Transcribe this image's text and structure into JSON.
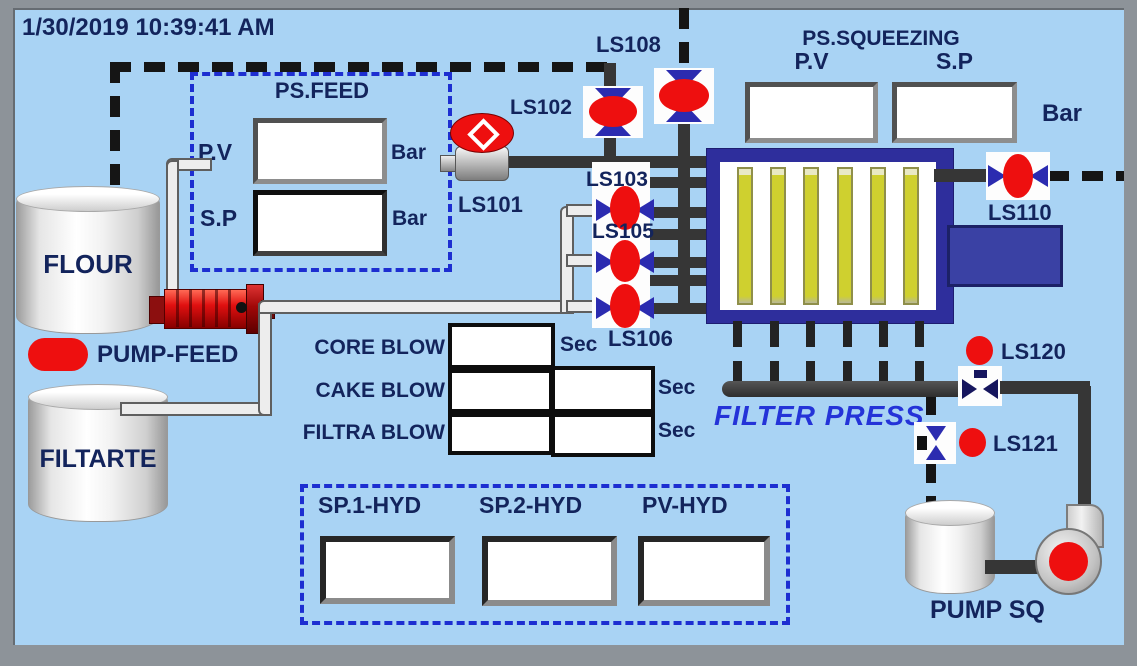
{
  "colors": {
    "background": "#a9d3f4",
    "frame_gray": "#8d9399",
    "text_navy": "#13245c",
    "dashed_blue": "#1d2ed1",
    "pipe_dark": "#363636",
    "alarm_red": "#ee0f0f",
    "valve_blue": "#2b2bb0",
    "press_frame_blue": "#2e2e9c",
    "plate_yellow": "#cfd02f",
    "press_head_blue": "#3a41a4",
    "filter_press_text": "#2433d8"
  },
  "header": {
    "timestamp": "1/30/2019 10:39:41 AM"
  },
  "ps_feed": {
    "title": "PS.FEED",
    "pv_label": "P.V",
    "pv_value": "",
    "pv_unit": "Bar",
    "sp_label": "S.P",
    "sp_value": "",
    "sp_unit": "Bar"
  },
  "ps_squeezing": {
    "title": "PS.SQUEEZING",
    "pv_label": "P.V",
    "pv_value": "",
    "sp_label": "S.P",
    "sp_value": "",
    "unit": "Bar"
  },
  "tanks": {
    "flour_label": "FLOUR",
    "filtrate_label": "FILTARTE"
  },
  "pump_feed": {
    "label": "PUMP-FEED"
  },
  "pump_sq": {
    "label": "PUMP SQ"
  },
  "filter_press": {
    "label": "FILTER PRESS"
  },
  "valves": {
    "ls101": "LS101",
    "ls102": "LS102",
    "ls103": "LS103",
    "ls105": "LS105",
    "ls106": "LS106",
    "ls108": "LS108",
    "ls110": "LS110",
    "ls120": "LS120",
    "ls121": "LS121"
  },
  "blow_timers": {
    "rows": [
      {
        "label": "CORE BLOW",
        "value1": "",
        "unit": "Sec"
      },
      {
        "label": "CAKE BLOW",
        "value1": "",
        "value2": "",
        "unit": "Sec"
      },
      {
        "label": "FILTRA BLOW",
        "value1": "",
        "value2": "",
        "unit": "Sec"
      }
    ]
  },
  "hydraulic": {
    "items": [
      {
        "label": "SP.1-HYD",
        "value": ""
      },
      {
        "label": "SP.2-HYD",
        "value": ""
      },
      {
        "label": "PV-HYD",
        "value": ""
      }
    ]
  }
}
